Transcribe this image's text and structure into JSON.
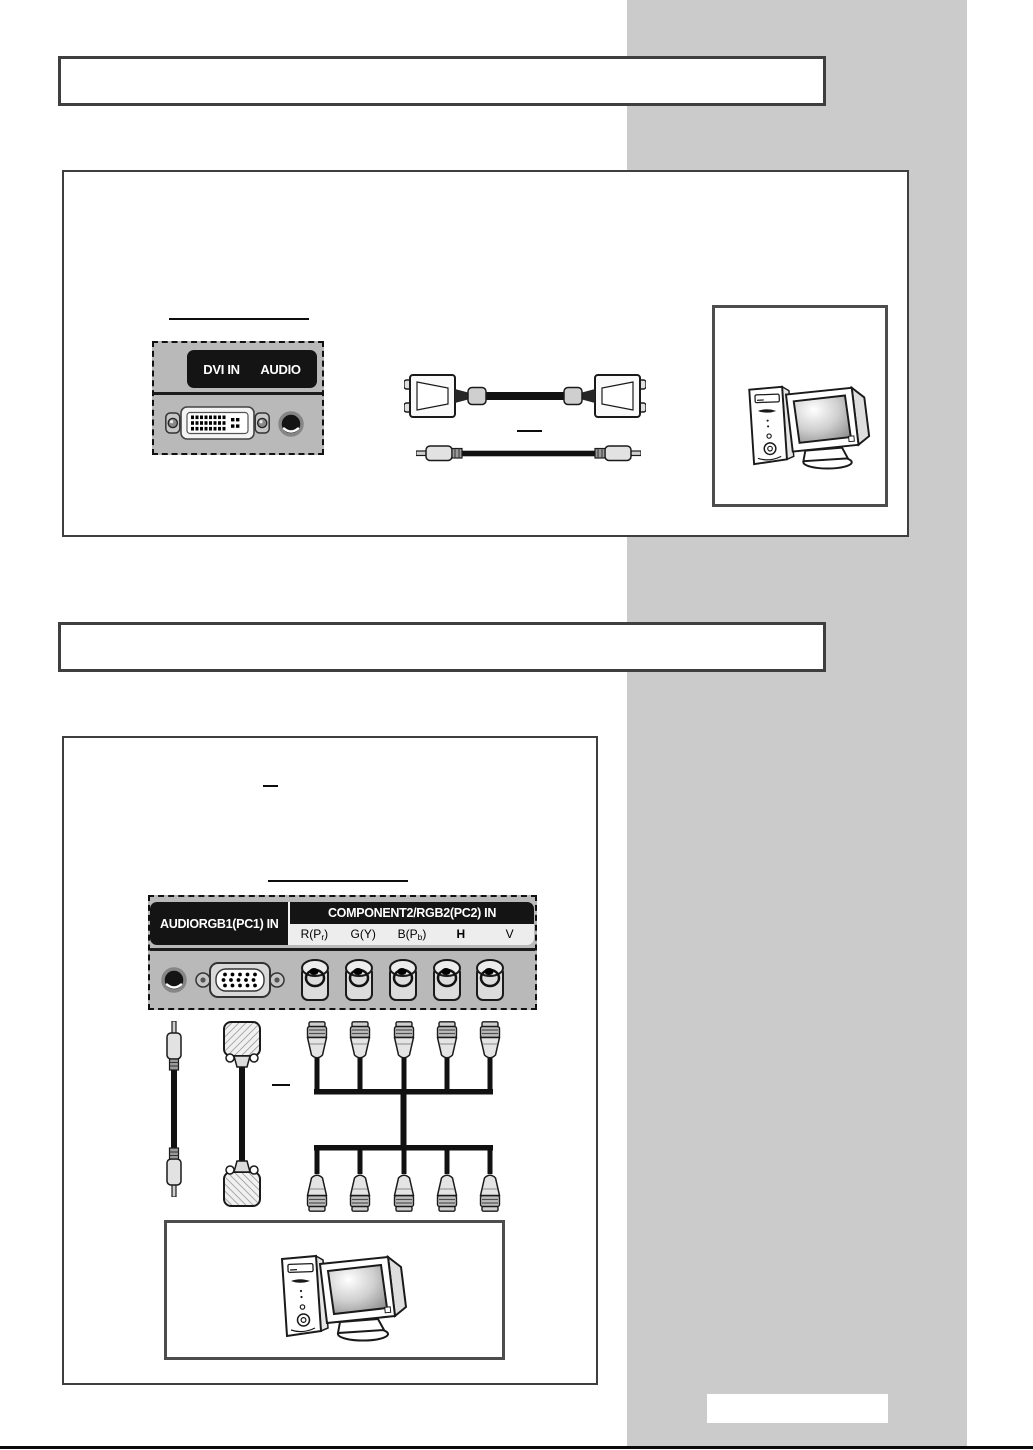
{
  "page_colors": {
    "sidebar": "#cbcbcb",
    "panel_background": "#b9b9b9",
    "label_bar": "#141414",
    "box_border": "#3f3f3f"
  },
  "section1": {
    "dvi_panel": {
      "dvi_label": "DVI IN",
      "audio_label": "AUDIO"
    },
    "illustrations": [
      "dvi-audio-input-panel",
      "dvi-cable",
      "rca-audio-cable",
      "computer"
    ]
  },
  "section2": {
    "io_panel": {
      "audio_label": "AUDIO",
      "rgb1_label": "RGB1(PC1) IN",
      "component_header": "COMPONENT2/RGB2(PC2) IN",
      "bnc_labels": [
        {
          "pre": "R(P",
          "sub": "r",
          "post": ")"
        },
        {
          "pre": "G(Y)",
          "sub": "",
          "post": ""
        },
        {
          "pre": "B(P",
          "sub": "b",
          "post": ")"
        },
        {
          "pre": "H",
          "sub": "",
          "post": ""
        },
        {
          "pre": "V",
          "sub": "",
          "post": ""
        }
      ]
    },
    "illustrations": [
      "audio-rgb1-component2-input-panel",
      "rca-audio-cable",
      "vga-cable",
      "bnc-harness-cable",
      "computer"
    ]
  }
}
